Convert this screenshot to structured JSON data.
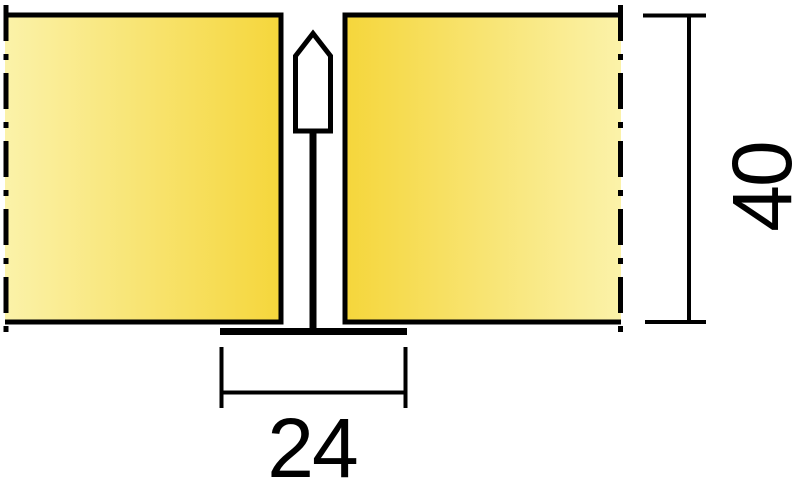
{
  "window": {
    "background": "#FFFFFF"
  },
  "drawing": {
    "type": "technical-section-detail",
    "subject": "two ceiling panels on exposed T24 suspension grid, cross-section",
    "panels": {
      "fill_light": "#FBF2A9",
      "fill_dark": "#F5D63B",
      "outline": "#000000"
    },
    "profile": {
      "fill": "#FFFFFF",
      "outline": "#000000"
    },
    "dimensions": {
      "flange_width": {
        "label": "24"
      },
      "system_height": {
        "label": "40"
      }
    },
    "line_color": "#000000"
  }
}
